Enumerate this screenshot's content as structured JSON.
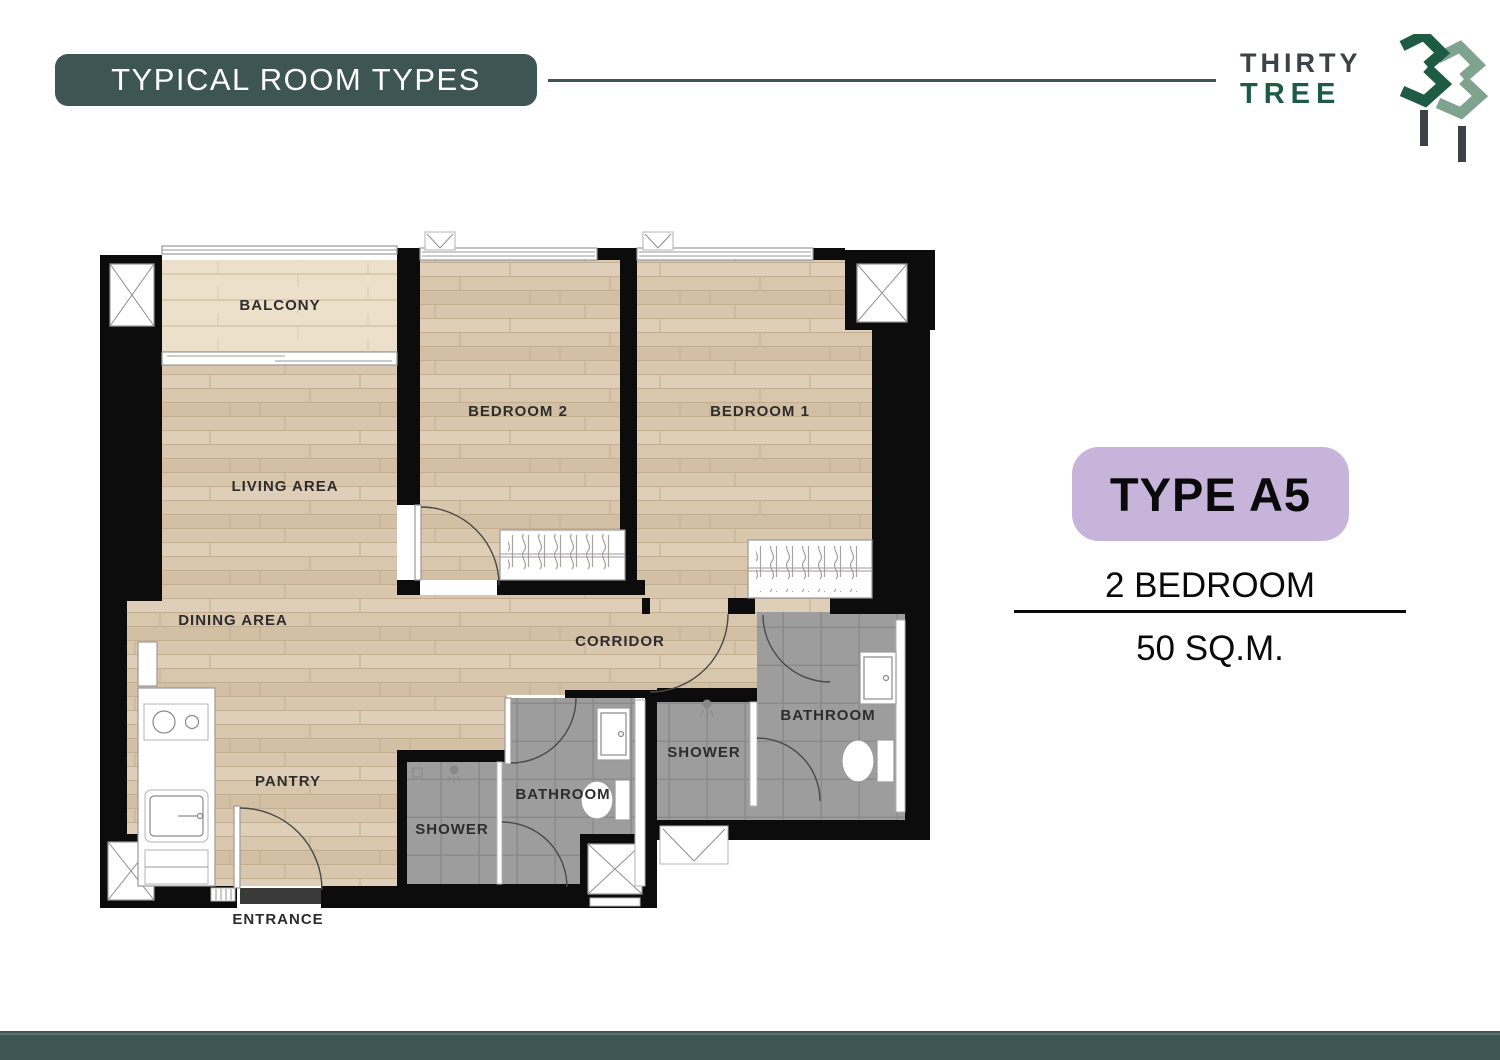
{
  "header": {
    "title": "TYPICAL ROOM TYPES"
  },
  "logo": {
    "word1": "THIRTY",
    "word2": "TREE",
    "mark": "33-twin-tree-mark"
  },
  "unit": {
    "badge": "TYPE A5",
    "bedrooms": "2 BEDROOM",
    "area": "50 SQ.M."
  },
  "floorplan": {
    "labels": {
      "balcony": "BALCONY",
      "living": "LIVING AREA",
      "dining": "DINING AREA",
      "pantry": "PANTRY",
      "bedroom2": "BEDROOM 2",
      "bedroom1": "BEDROOM 1",
      "corridor": "CORRIDOR",
      "bathroom_right": "BATHROOM",
      "shower_right": "SHOWER",
      "bathroom_mid": "BATHROOM",
      "shower_mid": "SHOWER",
      "entrance": "ENTRANCE"
    },
    "icons": [
      "stove-icon",
      "kitchen-sink-icon",
      "bathroom-sink-icon",
      "toilet-icon",
      "shower-head-icon",
      "wardrobe-icon",
      "window-icon",
      "column-x-icon",
      "door-swing-icon",
      "sliding-door-icon",
      "floor-drain-icon"
    ]
  },
  "colors": {
    "teal": "#3d5653",
    "lavender": "#c6b4da",
    "wall": "#0c0c0c",
    "wood": "#d8c6ad",
    "wood_row": "#dfcfb8",
    "wood_row2": "#d2bfa4",
    "wood_line": "#c3ae91",
    "balcony_wood": "#ece0cb",
    "balcony_line": "#d9cab0",
    "tile": "#9d9d9d",
    "tile_line": "#8a8a8a",
    "logo_gray": "#3c4245",
    "logo_green": "#1d5b44",
    "logo_sage": "#7fa38e",
    "label_ink": "#2d2d2d"
  }
}
